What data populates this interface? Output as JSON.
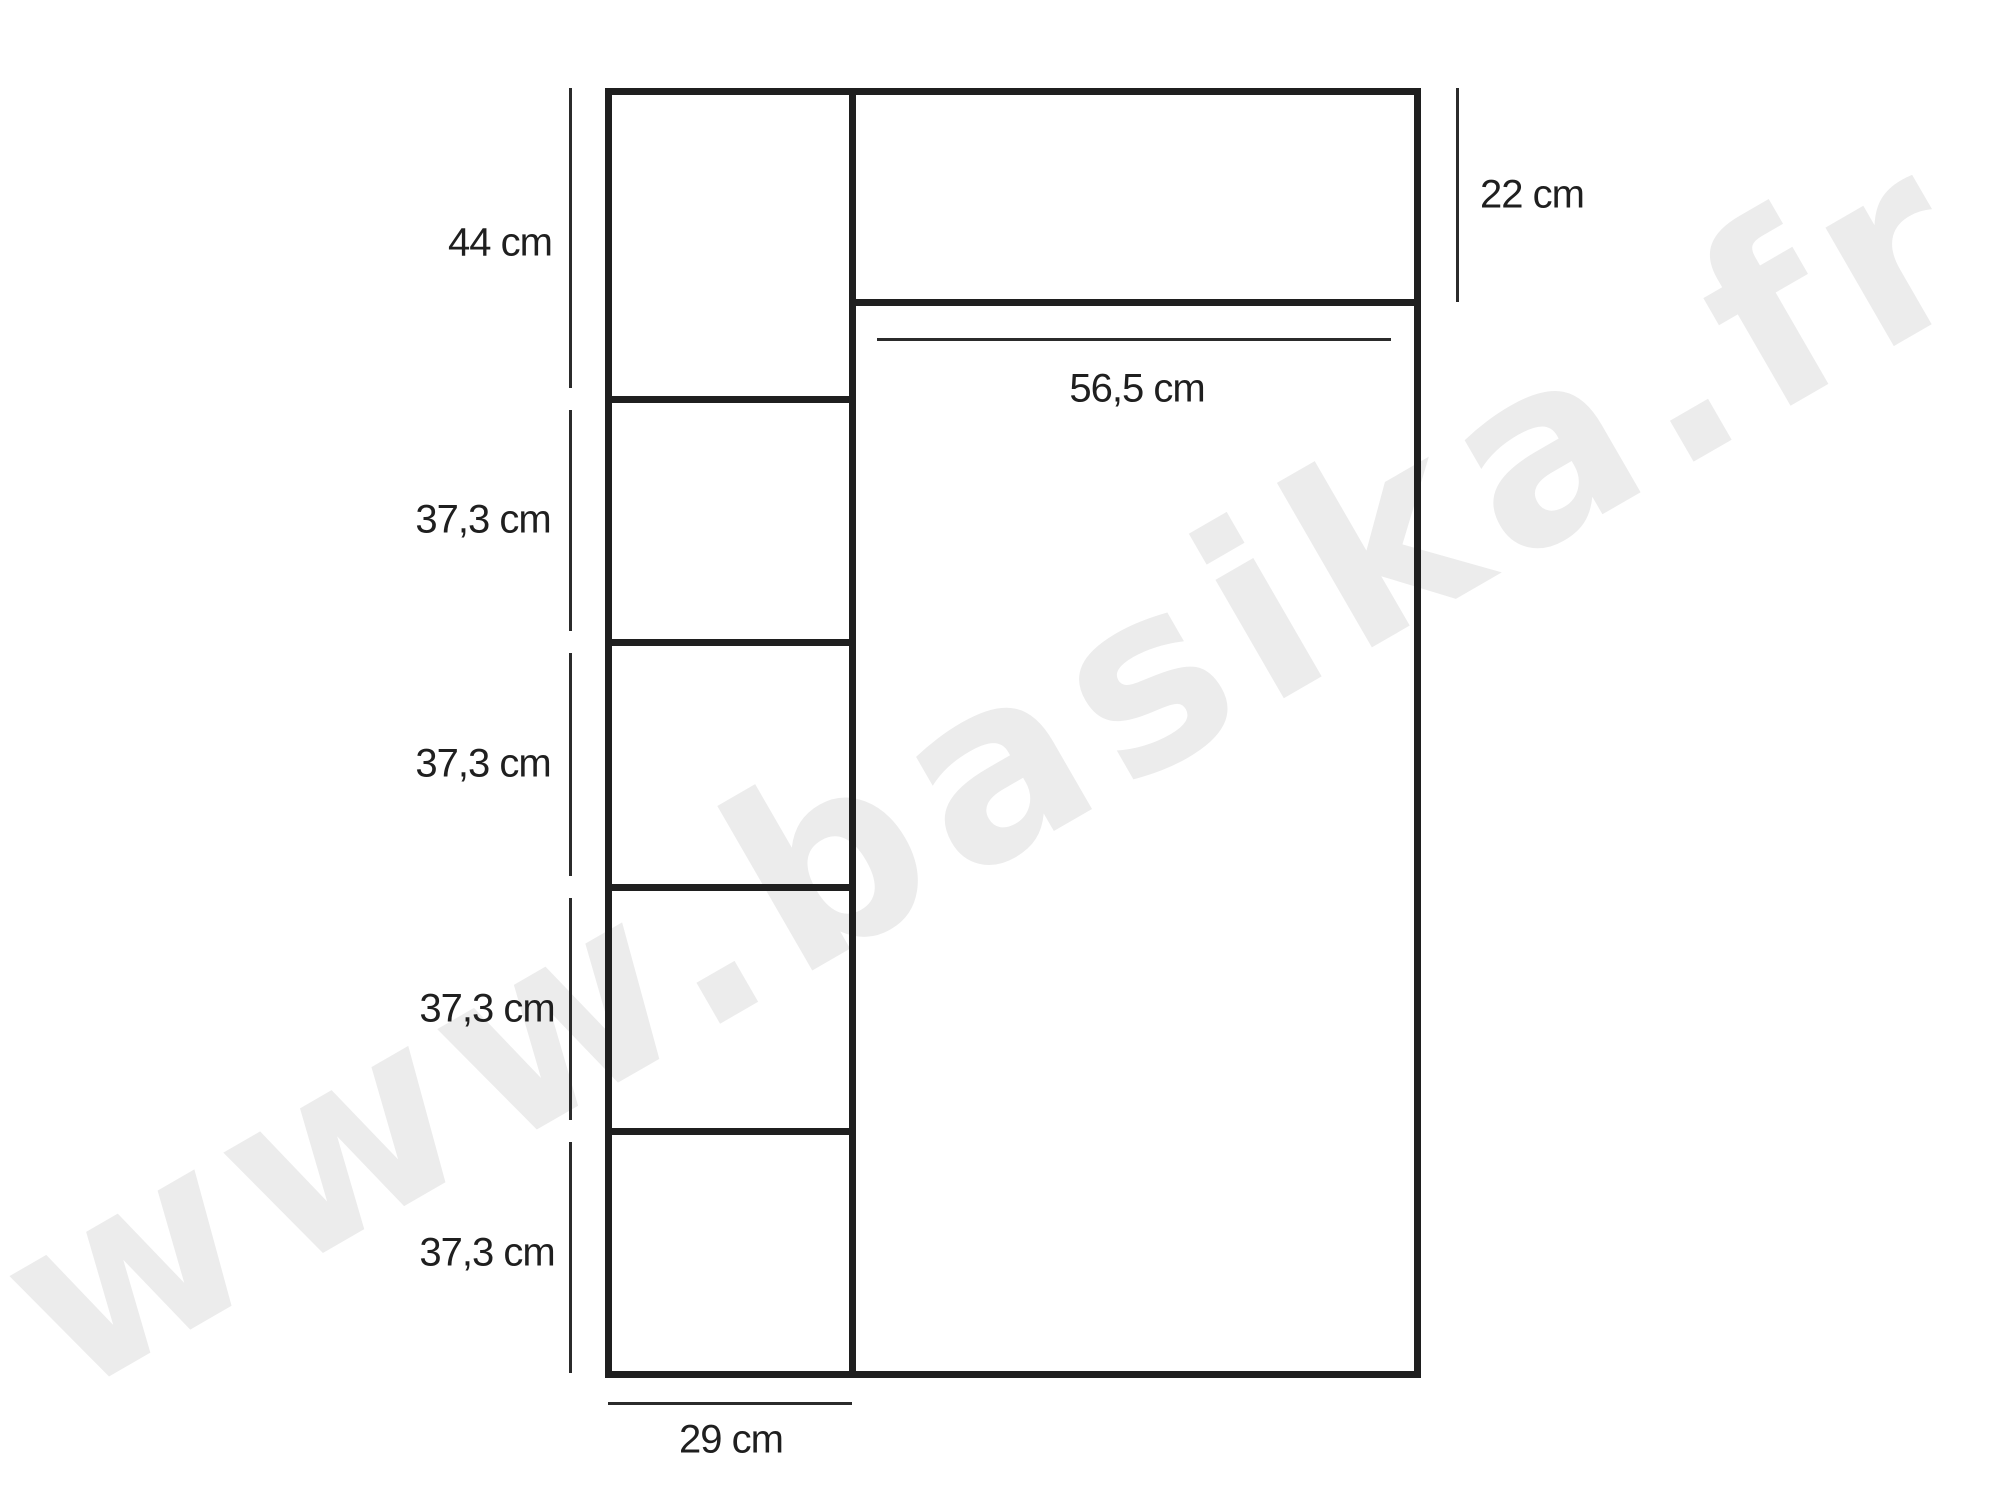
{
  "colors": {
    "bg": "#ffffff",
    "line": "#1f1f1f",
    "dim": "#2b2b2b",
    "label": "#1f1f1f",
    "watermark": "#ececec"
  },
  "watermark": {
    "text": "www.basika.fr"
  },
  "diagram": {
    "left_column": {
      "width_label": "29 cm",
      "compartments": [
        {
          "height_label": "44 cm"
        },
        {
          "height_label": "37,3 cm"
        },
        {
          "height_label": "37,3 cm"
        },
        {
          "height_label": "37,3 cm"
        },
        {
          "height_label": "37,3 cm"
        }
      ]
    },
    "right_section": {
      "top_drawer_height_label": "22 cm",
      "interior_width_label": "56,5 cm"
    }
  }
}
